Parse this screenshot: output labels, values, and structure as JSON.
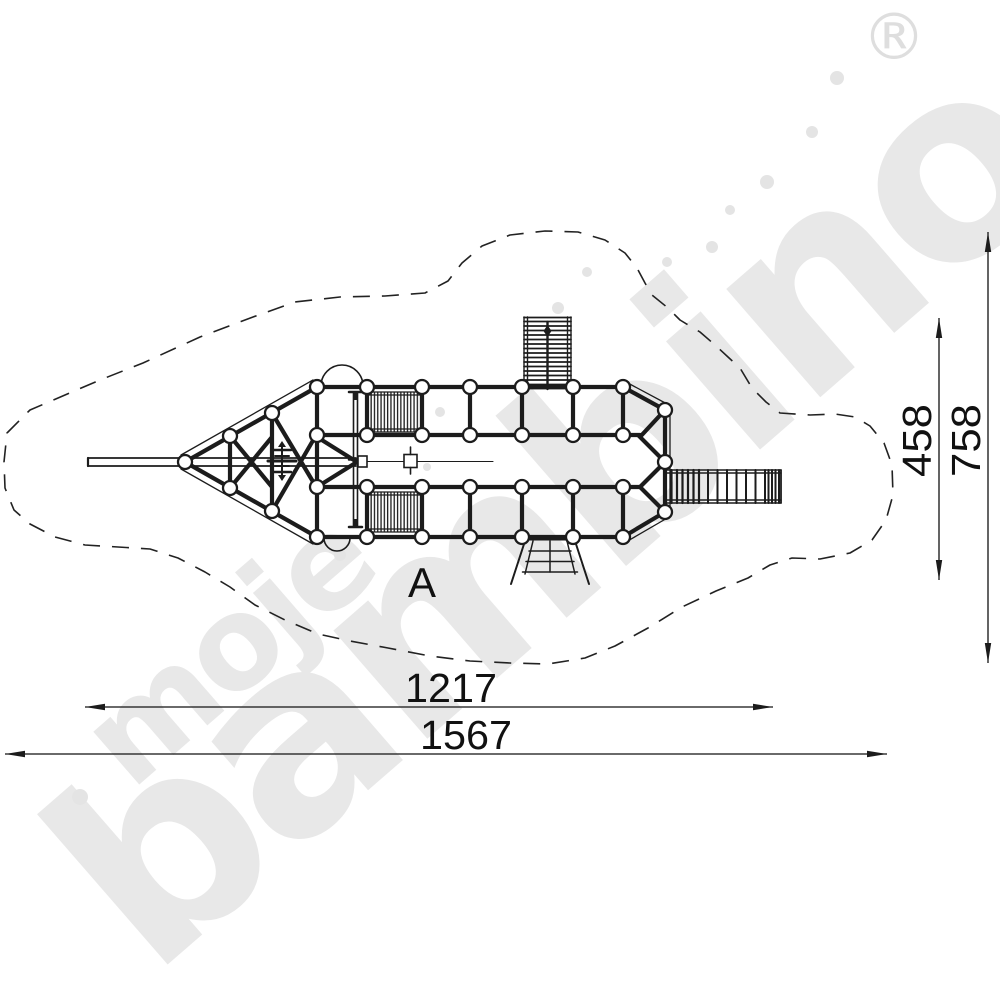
{
  "brand": {
    "watermark_word_1": "moje",
    "watermark_word_2": "bambino",
    "registered_mark": "®"
  },
  "plan": {
    "section_label": "A"
  },
  "dimensions": {
    "equipment_length": "1217",
    "safety_zone_length": "1567",
    "equipment_width": "458",
    "safety_zone_width": "758"
  },
  "colors": {
    "ink": "#1c1c1c",
    "dimension_ink": "#111111",
    "watermark": "#e8e8e8",
    "background": "#ffffff"
  }
}
